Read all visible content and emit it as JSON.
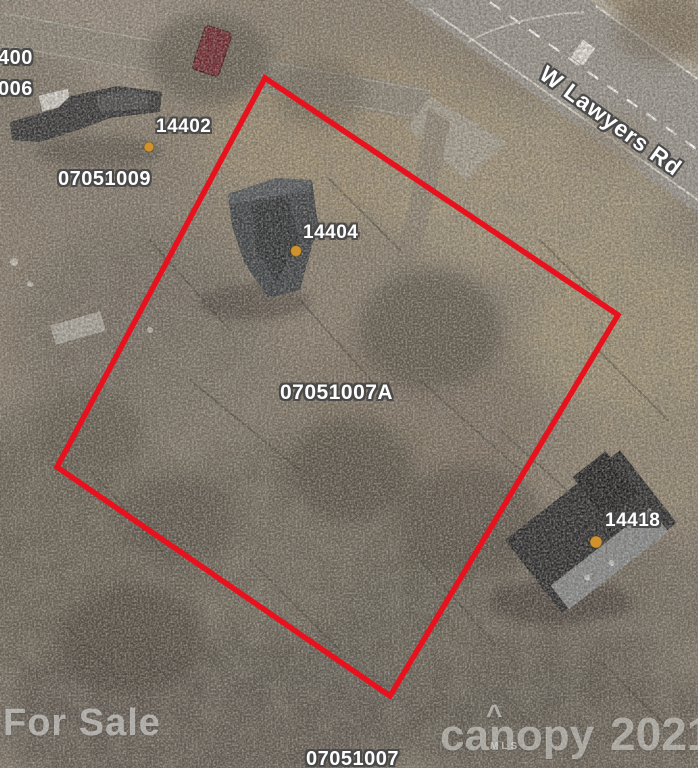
{
  "map": {
    "street_label": "W Lawyers Rd",
    "parcel_labels": [
      {
        "id": "parcel-400",
        "text": "400"
      },
      {
        "id": "parcel-006",
        "text": "006"
      },
      {
        "id": "parcel-07051009",
        "text": "07051009"
      },
      {
        "id": "parcel-07051007A",
        "text": "07051007A"
      },
      {
        "id": "parcel-07051007",
        "text": "07051007"
      }
    ],
    "address_labels": [
      {
        "id": "address-14402",
        "text": "14402"
      },
      {
        "id": "address-14404",
        "text": "14404"
      },
      {
        "id": "address-14418",
        "text": "14418"
      }
    ]
  },
  "watermarks": {
    "for_sale": "For Sale",
    "brand": "canopy",
    "brand_mark": "^",
    "brand_sub": "MLS",
    "year": "2021"
  },
  "colors": {
    "parcel_boundary": "#e8111e",
    "address_marker": "#d0922e",
    "label_text": "#ffffff"
  }
}
